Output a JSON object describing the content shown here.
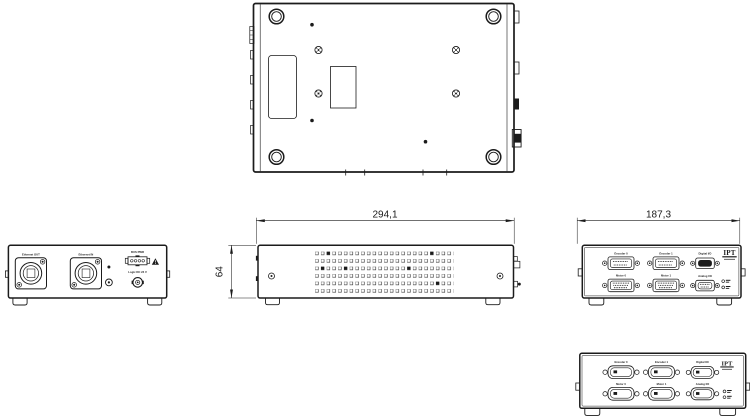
{
  "colors": {
    "background": "#ffffff",
    "line": "#1b1b1b"
  },
  "dimensions": {
    "body_width": "294,1",
    "body_height": "64",
    "panel_width": "187,3"
  },
  "rear_panel": {
    "ethernet_out": "Ethernet OUT",
    "ethernet_in": "Ethernet IN",
    "bus_pwr": "BUS PWR",
    "logic_supply": "Logic DC 24 V"
  },
  "io_panel": {
    "logo": "IPT",
    "connectors": [
      {
        "label": "Encoder 0"
      },
      {
        "label": "Encoder 1"
      },
      {
        "label": "Digital I/O"
      },
      {
        "label": "Motor 0"
      },
      {
        "label": "Motor 1"
      },
      {
        "label": "Analog I/O"
      }
    ]
  }
}
